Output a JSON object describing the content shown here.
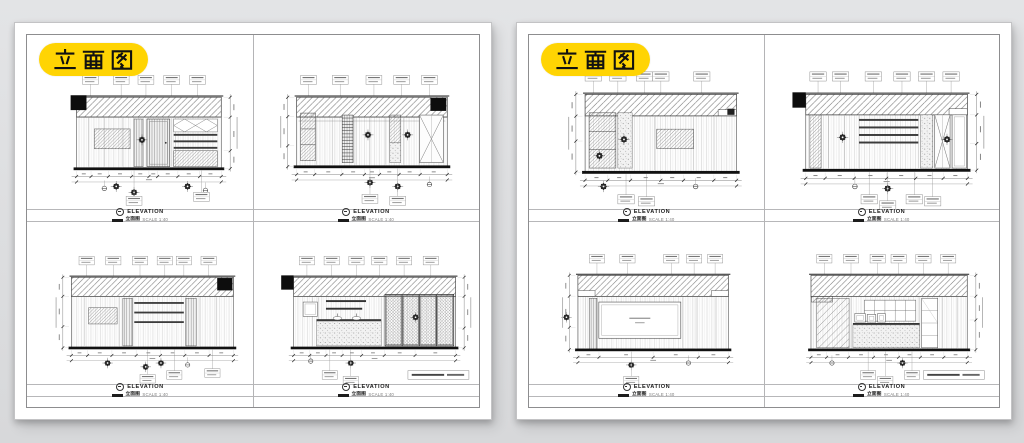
{
  "meta": {
    "description": "Two white CAD sheets on grey background, each titled with a yellow pill badge and containing four interior elevation drawings in a 2x2 grid"
  },
  "colors": {
    "background": "#DCDDE0",
    "paper": "#FFFFFF",
    "badge_yellow": "#FFD403",
    "badge_text": "#111111",
    "line_dark": "#444444",
    "frame_line": "#8D8D8F",
    "baseline_black": "#111111"
  },
  "badge": {
    "label": "立面图"
  },
  "elevation_label": {
    "title": "ELEVATION",
    "cn": "立面图",
    "scale": "SCALE 1:40"
  },
  "note_box": {
    "present_on": [
      "p1-d",
      "p2-d"
    ],
    "text_legible": false
  },
  "sheets": [
    {
      "name": "sheet-1",
      "badge": "立面图",
      "drawing_ids": [
        "p1-a",
        "p1-b",
        "p1-c",
        "p1-d"
      ]
    },
    {
      "name": "sheet-2",
      "badge": "立面图",
      "drawing_ids": [
        "p2-a",
        "p2-b",
        "p2-c",
        "p2-d"
      ]
    }
  ],
  "drawings": [
    {
      "id": "p1-a",
      "wall": {
        "x": 50,
        "y": 60,
        "w": 146,
        "h": 72
      },
      "band": 20,
      "block": "left",
      "vdim": "right",
      "joints": [
        62,
        78,
        96,
        108,
        122,
        146,
        150
      ],
      "panels": [
        {
          "x": 68,
          "y": 92,
          "w": 36,
          "h": 20,
          "f": "hatch2"
        },
        {
          "x": 108,
          "y": 82,
          "w": 9,
          "h": 48,
          "f": "wood-dark"
        },
        {
          "x": 121,
          "y": 82,
          "w": 23,
          "h": 48,
          "f": "door"
        },
        {
          "x": 148,
          "y": 82,
          "w": 44,
          "h": 13,
          "f": "xgrid"
        },
        {
          "x": 148,
          "y": 97,
          "w": 44,
          "h": 15,
          "f": "louver3"
        },
        {
          "x": 148,
          "y": 114,
          "w": 44,
          "h": 16,
          "f": "hatch2"
        }
      ],
      "flowers": [
        [
          116,
          103
        ],
        [
          90,
          150
        ],
        [
          108,
          156
        ],
        [
          162,
          150
        ]
      ],
      "circles": [
        [
          78,
          152
        ],
        [
          180,
          154
        ]
      ],
      "tags_top": [
        64,
        95,
        120,
        146,
        172
      ],
      "tags_bottom": [
        [
          108,
          160
        ],
        [
          176,
          156
        ]
      ],
      "hticks": [
        0,
        0.1,
        0.22,
        0.38,
        0.5,
        0.56,
        0.7,
        0.85,
        1
      ],
      "vticks": [
        0,
        0.28,
        0.75,
        1
      ],
      "notebox": false
    },
    {
      "id": "p1-b",
      "wall": {
        "x": 44,
        "y": 60,
        "w": 152,
        "h": 70
      },
      "band": 20,
      "block": "right",
      "vdim": "left",
      "rail": true,
      "joints": [
        64,
        80,
        104,
        118,
        134,
        152,
        168
      ],
      "panels": [
        {
          "x": 48,
          "y": 76,
          "w": 15,
          "h": 48,
          "f": "shelfstack"
        },
        {
          "x": 90,
          "y": 78,
          "w": 11,
          "h": 48,
          "f": "ladder"
        },
        {
          "x": 138,
          "y": 78,
          "w": 11,
          "h": 28,
          "f": "hatch2"
        },
        {
          "x": 138,
          "y": 106,
          "w": 11,
          "h": 20,
          "f": "speckle"
        },
        {
          "x": 168,
          "y": 78,
          "w": 24,
          "h": 48,
          "f": "xbrace"
        }
      ],
      "flowers": [
        [
          116,
          98
        ],
        [
          156,
          98
        ],
        [
          118,
          146
        ],
        [
          146,
          150
        ]
      ],
      "circles": [
        [
          178,
          148
        ]
      ],
      "tags_top": [
        56,
        88,
        122,
        150,
        178
      ],
      "tags_bottom": [
        [
          118,
          158
        ],
        [
          146,
          160
        ]
      ],
      "hticks": [
        0,
        0.12,
        0.3,
        0.45,
        0.55,
        0.68,
        0.82,
        1
      ],
      "vticks": [
        0,
        0.28,
        0.7,
        1
      ],
      "notebox": false
    },
    {
      "id": "p1-c",
      "wall": {
        "x": 42,
        "y": 58,
        "w": 170,
        "h": 74
      },
      "band": 20,
      "block": "right",
      "vdim": "left",
      "joints": [
        56,
        92,
        106,
        162,
        176,
        194
      ],
      "panels": [
        {
          "x": 60,
          "y": 90,
          "w": 30,
          "h": 17,
          "f": "hatch2"
        },
        {
          "x": 96,
          "y": 80,
          "w": 10,
          "h": 50,
          "f": "wood-dark"
        },
        {
          "x": 108,
          "y": 84,
          "w": 52,
          "h": 22,
          "f": "louver3"
        },
        {
          "x": 162,
          "y": 80,
          "w": 11,
          "h": 50,
          "f": "wood-dark"
        }
      ],
      "flowers": [
        [
          80,
          148
        ],
        [
          120,
          152
        ],
        [
          136,
          148
        ]
      ],
      "circles": [
        [
          164,
          150
        ]
      ],
      "tags_top": [
        58,
        86,
        114,
        140,
        160,
        186
      ],
      "tags_bottom": [
        [
          122,
          160
        ],
        [
          150,
          156
        ],
        [
          190,
          154
        ]
      ],
      "hticks": [
        0,
        0.1,
        0.25,
        0.4,
        0.55,
        0.7,
        0.85,
        1
      ],
      "vticks": [
        0,
        0.27,
        0.7,
        1
      ],
      "notebox": false
    },
    {
      "id": "p1-d",
      "wall": {
        "x": 38,
        "y": 58,
        "w": 170,
        "h": 74
      },
      "band": 20,
      "block": "out-left",
      "vdim": "right",
      "joints": [
        58,
        64,
        130,
        134
      ],
      "panels": [
        {
          "x": 48,
          "y": 84,
          "w": 15,
          "h": 15,
          "f": "white-inner"
        },
        {
          "x": 72,
          "y": 82,
          "w": 42,
          "h": 2,
          "f": "bar"
        },
        {
          "x": 72,
          "y": 90,
          "w": 38,
          "h": 2,
          "f": "bar"
        },
        {
          "x": 62,
          "y": 102,
          "w": 68,
          "h": 2,
          "f": "bar"
        },
        {
          "x": 62,
          "y": 104,
          "w": 68,
          "h": 26,
          "f": "speckle"
        },
        {
          "x": 84,
          "y": 101,
          "w": 0,
          "h": 0,
          "f": "basin"
        },
        {
          "x": 104,
          "y": 101,
          "w": 0,
          "h": 0,
          "f": "basin"
        },
        {
          "x": 134,
          "y": 76,
          "w": 72,
          "h": 54,
          "f": "doors4"
        }
      ],
      "flowers": [
        [
          166,
          100
        ],
        [
          98,
          148
        ]
      ],
      "circles": [
        [
          56,
          146
        ]
      ],
      "tags_top": [
        52,
        78,
        104,
        128,
        154,
        182
      ],
      "tags_bottom": [
        [
          76,
          156
        ],
        [
          98,
          162
        ]
      ],
      "hticks": [
        0,
        0.1,
        0.2,
        0.3,
        0.42,
        0.56,
        0.75,
        1
      ],
      "vticks": [
        0,
        0.27,
        0.72,
        1
      ],
      "notebox": true
    },
    {
      "id": "p2-a",
      "wall": {
        "x": 54,
        "y": 58,
        "w": 148,
        "h": 76
      },
      "band": 21,
      "block": "mark-right",
      "step": "right",
      "vdim": "left",
      "joints": [
        100,
        122,
        160,
        180
      ],
      "panels": [
        {
          "x": 58,
          "y": 76,
          "w": 26,
          "h": 54,
          "f": "shelfstack"
        },
        {
          "x": 86,
          "y": 76,
          "w": 14,
          "h": 54,
          "f": "speckle"
        },
        {
          "x": 124,
          "y": 92,
          "w": 36,
          "h": 19,
          "f": "hatch2"
        }
      ],
      "flowers": [
        [
          92,
          102
        ],
        [
          68,
          118
        ],
        [
          72,
          148
        ]
      ],
      "circles": [
        [
          162,
          148
        ]
      ],
      "tags_top": [
        62,
        86,
        112,
        128,
        168
      ],
      "tags_bottom": [
        [
          94,
          156
        ],
        [
          114,
          158
        ]
      ],
      "hticks": [
        0,
        0.15,
        0.3,
        0.5,
        0.65,
        0.85,
        1
      ],
      "vticks": [
        0,
        0.28,
        0.6,
        1
      ],
      "notebox": false
    },
    {
      "id": "p2-b",
      "wall": {
        "x": 40,
        "y": 58,
        "w": 158,
        "h": 74
      },
      "band": 20,
      "block": "out-left",
      "step": "right",
      "vdim": "right",
      "joints": [
        62,
        78,
        92,
        150
      ],
      "panels": [
        {
          "x": 44,
          "y": 78,
          "w": 11,
          "h": 52,
          "f": "hatch2"
        },
        {
          "x": 92,
          "y": 82,
          "w": 58,
          "h": 24,
          "f": "louver4"
        },
        {
          "x": 152,
          "y": 78,
          "w": 12,
          "h": 52,
          "f": "speckle"
        },
        {
          "x": 166,
          "y": 78,
          "w": 15,
          "h": 52,
          "f": "xbrace"
        },
        {
          "x": 183,
          "y": 78,
          "w": 14,
          "h": 52,
          "f": "white-inner"
        }
      ],
      "flowers": [
        [
          76,
          100
        ],
        [
          178,
          102
        ],
        [
          120,
          150
        ]
      ],
      "circles": [
        [
          88,
          148
        ]
      ],
      "tags_top": [
        52,
        74,
        106,
        134,
        158,
        182
      ],
      "tags_bottom": [
        [
          102,
          156
        ],
        [
          120,
          162
        ],
        [
          146,
          156
        ],
        [
          164,
          158
        ]
      ],
      "hticks": [
        0,
        0.12,
        0.3,
        0.5,
        0.68,
        0.85,
        1
      ],
      "vticks": [
        0,
        0.27,
        0.65,
        1
      ],
      "notebox": false
    },
    {
      "id": "p2-c",
      "wall": {
        "x": 42,
        "y": 56,
        "w": 158,
        "h": 78
      },
      "band": 22,
      "block": null,
      "step": "both",
      "vdim": "left",
      "joints": [
        50,
        152,
        166,
        186
      ],
      "panels": [
        {
          "x": 54,
          "y": 80,
          "w": 8,
          "h": 54,
          "f": "wood-dark"
        },
        {
          "x": 64,
          "y": 84,
          "w": 86,
          "h": 38,
          "f": "panel-inset"
        }
      ],
      "flowers": [
        [
          30,
          100
        ],
        [
          98,
          150
        ]
      ],
      "circles": [
        [
          158,
          148
        ]
      ],
      "tags_top": [
        62,
        94,
        140,
        164,
        186
      ],
      "tags_bottom": [
        [
          98,
          162
        ]
      ],
      "hticks": [
        0,
        0.14,
        0.5,
        0.8,
        1
      ],
      "vticks": [
        0,
        0.28,
        0.7,
        1
      ],
      "notebox": false
    },
    {
      "id": "p2-d",
      "wall": {
        "x": 40,
        "y": 56,
        "w": 164,
        "h": 78
      },
      "band": 22,
      "block": null,
      "step": "left-deep",
      "vdim": "right",
      "joints": [
        82,
        154,
        178,
        194
      ],
      "panels": [
        {
          "x": 46,
          "y": 80,
          "w": 34,
          "h": 52,
          "f": "hatch-big"
        },
        {
          "x": 96,
          "y": 82,
          "w": 54,
          "h": 22,
          "f": "grid"
        },
        {
          "x": 84,
          "y": 106,
          "w": 70,
          "h": 2,
          "f": "bar"
        },
        {
          "x": 84,
          "y": 108,
          "w": 70,
          "h": 24,
          "f": "speckle"
        },
        {
          "x": 86,
          "y": 96,
          "w": 11,
          "h": 9,
          "f": "white-inner"
        },
        {
          "x": 99,
          "y": 97,
          "w": 9,
          "h": 8,
          "f": "white-inner"
        },
        {
          "x": 110,
          "y": 96,
          "w": 8,
          "h": 9,
          "f": "white-inner"
        },
        {
          "x": 156,
          "y": 80,
          "w": 17,
          "h": 52,
          "f": "shelfcab"
        }
      ],
      "flowers": [
        [
          136,
          148
        ]
      ],
      "circles": [
        [
          62,
          148
        ]
      ],
      "tags_top": [
        54,
        82,
        110,
        132,
        158,
        184
      ],
      "tags_bottom": [
        [
          100,
          156
        ],
        [
          118,
          162
        ],
        [
          146,
          156
        ]
      ],
      "hticks": [
        0,
        0.1,
        0.24,
        0.4,
        0.56,
        0.7,
        0.85,
        1
      ],
      "vticks": [
        0,
        0.28,
        0.6,
        1
      ],
      "notebox": true
    }
  ]
}
